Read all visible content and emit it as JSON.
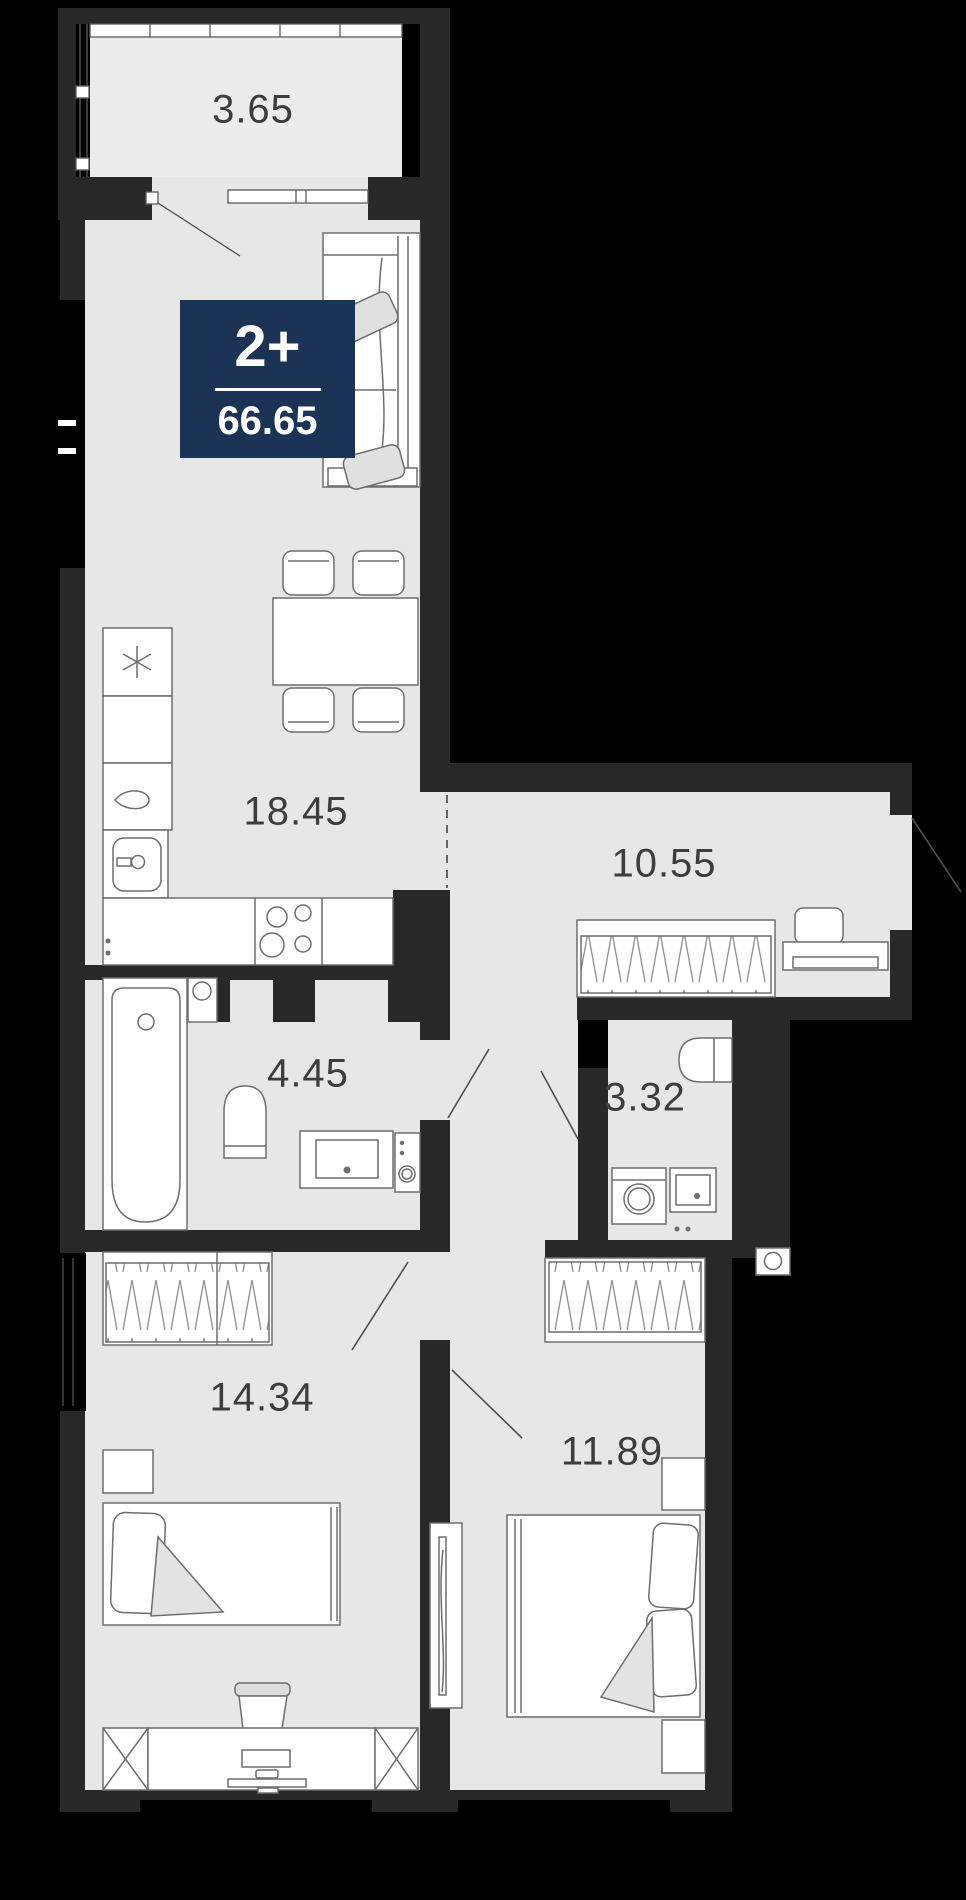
{
  "unit": {
    "rooms_label": "2+",
    "area": "66.65"
  },
  "rooms": [
    {
      "name": "balcony",
      "area": "3.65"
    },
    {
      "name": "kitchen-living-room",
      "area": "18.45"
    },
    {
      "name": "hallway",
      "area": "10.55"
    },
    {
      "name": "bathroom",
      "area": "4.45"
    },
    {
      "name": "wc",
      "area": "3.32"
    },
    {
      "name": "bedroom",
      "area": "14.34"
    },
    {
      "name": "bedroom-2",
      "area": "11.89"
    }
  ],
  "colors": {
    "background": "#000000",
    "walls": "#282828",
    "floor": "#e7e7e7",
    "balcony_floor": "#ececec",
    "badge": "#1b3456",
    "badge_text": "#ffffff",
    "label_text": "#3d3d3d",
    "furniture_outline": "#6e6e6e"
  }
}
